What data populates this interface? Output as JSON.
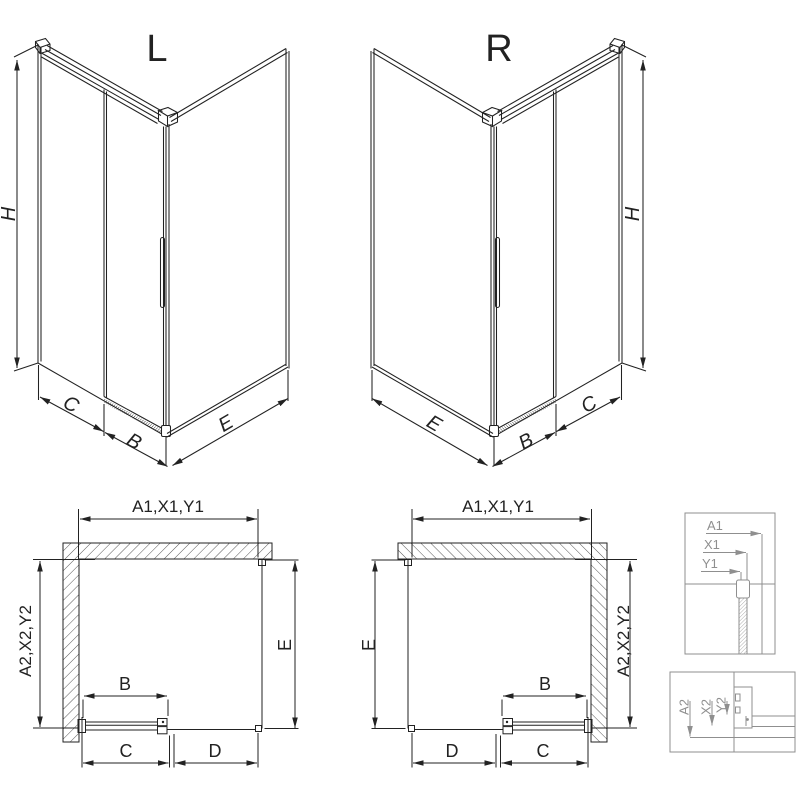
{
  "drawing": {
    "variant_left": {
      "title": "L",
      "height": "H",
      "side_panel": "C",
      "door": "B",
      "wall_panel": "E"
    },
    "variant_right": {
      "title": "R",
      "height": "H",
      "side_panel": "C",
      "door": "B",
      "wall_panel": "E"
    },
    "plan_left": {
      "width_total": "A1,X1,Y1",
      "depth_total": "A2,X2,Y2",
      "depth_glass": "E",
      "door": "B",
      "side": "C",
      "entry": "D"
    },
    "plan_right": {
      "width_total": "A1,X1,Y1",
      "depth_total": "A2,X2,Y2",
      "depth_glass": "E",
      "door": "B",
      "side": "C",
      "entry": "D"
    },
    "detail_width": {
      "row_a": "A1",
      "row_x": "X1",
      "row_y": "Y1"
    },
    "detail_depth": {
      "row_a": "A2",
      "row_x": "X2",
      "row_y": "Y2"
    }
  },
  "colors": {
    "line": "#222222",
    "detail_line": "#8f8f8f",
    "background": "#ffffff"
  }
}
